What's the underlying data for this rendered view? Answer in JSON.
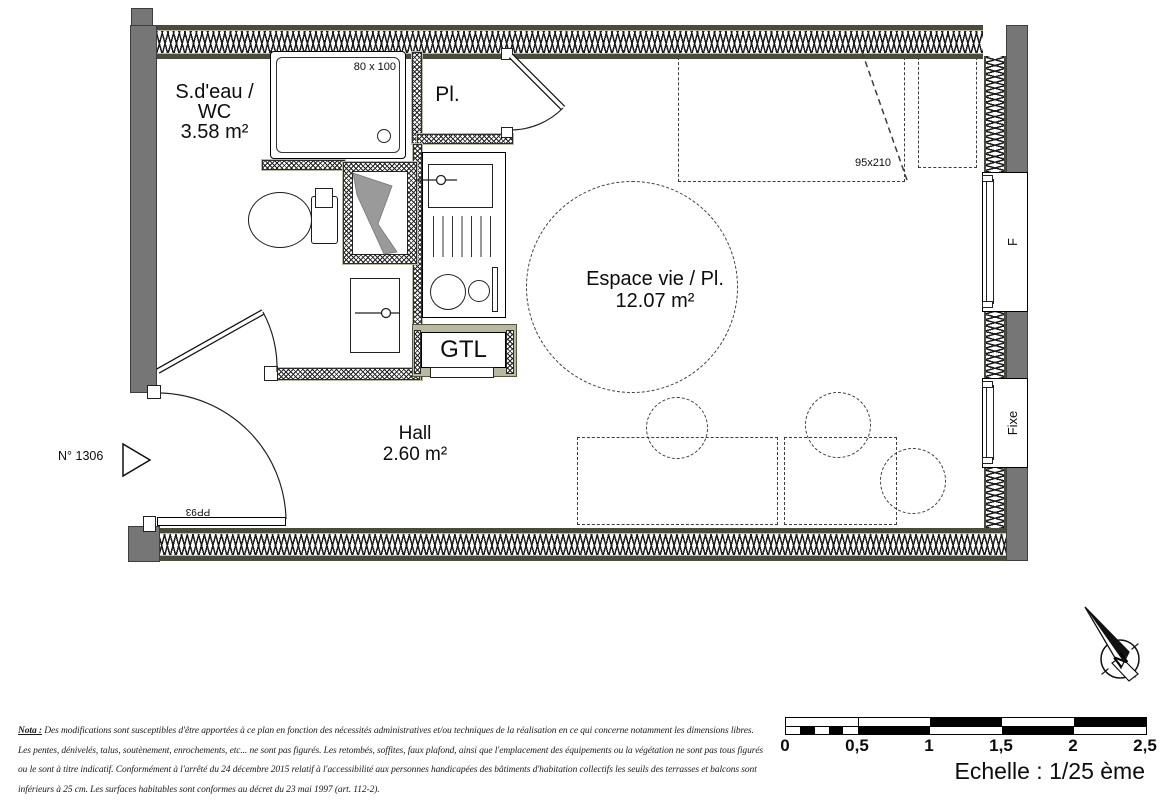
{
  "floorplan": {
    "bathroom": {
      "line1": "S.d'eau /",
      "line2": "WC",
      "area": "3.58 m²"
    },
    "closet": {
      "label": "Pl."
    },
    "living": {
      "label": "Espace vie / Pl.",
      "area": "12.07 m²"
    },
    "hall": {
      "label": "Hall",
      "area": "2.60 m²"
    },
    "gtl": {
      "label": "GTL"
    },
    "shower": {
      "dimensions": "80 x 100"
    },
    "wardrobe": {
      "dimensions": "95x210"
    },
    "entry": {
      "unit_number": "N° 1306",
      "door_ref": "PP93"
    },
    "windows": {
      "f": "F",
      "fixe": "Fixe"
    },
    "compass": {
      "letter": "N"
    }
  },
  "scalebar": {
    "ticks": [
      "0",
      "0,5",
      "1",
      "1,5",
      "2",
      "2,5"
    ],
    "caption": "Echelle : 1/25 ème"
  },
  "nota": {
    "prefix": "Nota :",
    "line1": "Des modifications sont susceptibles d'être apportées à ce plan en fonction des nécessités administratives et/ou techniques de la réalisation en ce qui concerne notamment les dimensions libres.",
    "line2": "Les pentes, dénivelés, talus, soutènement, enrochements, etc... ne sont pas figurés. Les retombés, soffites, faux plafond, ainsi que l'emplacement des équipements ou la végétation ne sont pas tous figurés",
    "line3": "ou le sont à titre indicatif. Conformément à l'arrêté du 24 décembre 2015 relatif à l'accessibilité aux personnes handicapées des bâtiments d'habitation collectifs les seuils des terrasses et balcons sont",
    "line4": "inférieurs à 25 cm. Les surfaces habitables sont conformes au décret du 23 mai 1997 (art. 112-2)."
  },
  "colors": {
    "wall_gray": "#767676",
    "wall_trim": "#4b4b3b",
    "wall_tan": "#b9b9a0",
    "line": "#000000"
  }
}
